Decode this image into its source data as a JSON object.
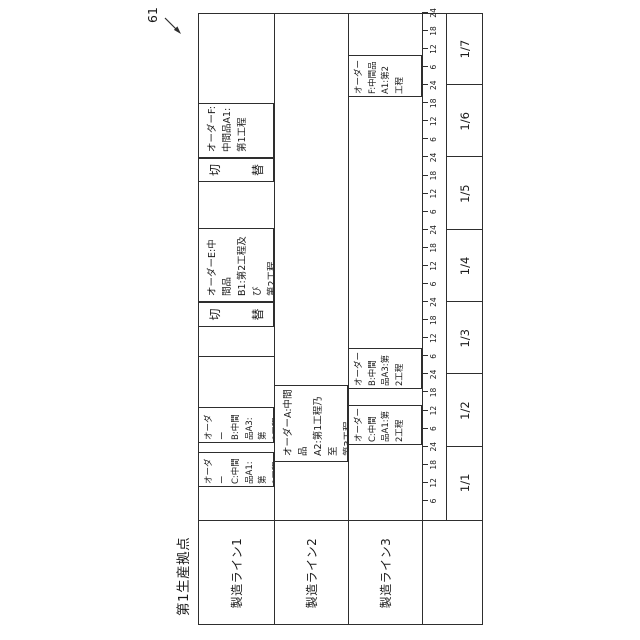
{
  "figure": {
    "ref_label": "61",
    "title": "第1生産拠点",
    "row_labels": [
      "製造ライン1",
      "製造ライン2",
      "製造ライン3"
    ],
    "day_labels": [
      "1/1",
      "1/2",
      "1/3",
      "1/4",
      "1/5",
      "1/6",
      "1/7"
    ],
    "hour_tick_labels": [
      "6",
      "12",
      "18",
      "24"
    ],
    "changeover_label": "切替",
    "changeover_chars": [
      "切",
      "替"
    ],
    "bars": [
      {
        "row": 0,
        "start": 153,
        "end": 188,
        "kind": "order",
        "text": "オーダー\nC:中間\n品A1:第\n1工程"
      },
      {
        "row": 0,
        "start": 197,
        "end": 233,
        "kind": "order",
        "text": "オーダー\nB:中間\n品A3:第\n1工程"
      },
      {
        "row": 0,
        "start": 313,
        "end": 338,
        "kind": "changeover",
        "text": "切替"
      },
      {
        "row": 0,
        "start": 338,
        "end": 412,
        "kind": "order",
        "text": "オーダーE:中間品\nB1:第2工程及び\n第2工程"
      },
      {
        "row": 0,
        "start": 458,
        "end": 482,
        "kind": "changeover",
        "text": "切替"
      },
      {
        "row": 0,
        "start": 482,
        "end": 537,
        "kind": "order",
        "text": "オーダーF:\n中間品A1:\n第1工程"
      },
      {
        "row": 1,
        "start": 178,
        "end": 255,
        "kind": "order",
        "text": "オーダーA:中間品\nA2:第1工程乃至\n第3工程"
      },
      {
        "row": 2,
        "start": 195,
        "end": 235,
        "kind": "order",
        "text": "オーダー\nC:中間\n品A1:第\n2工程"
      },
      {
        "row": 2,
        "start": 251,
        "end": 292,
        "kind": "order",
        "text": "オーダー\nB:中間\n品A3:第\n2工程"
      },
      {
        "row": 2,
        "start": 543,
        "end": 585,
        "kind": "order",
        "text": "オーダー\nF:中間品\nA1:第2\n工程"
      }
    ]
  }
}
